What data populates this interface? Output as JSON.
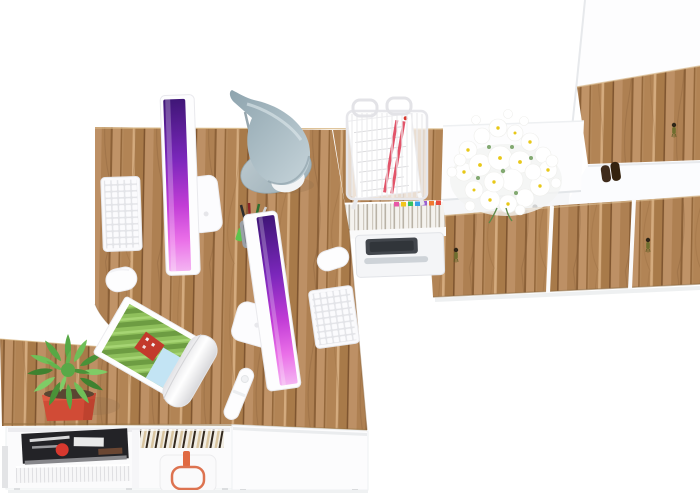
{
  "image": {
    "description": "Top-down 3D render of a two-person home office workstation with oak and white furniture",
    "background": "#ffffff"
  },
  "palette": {
    "wood_base": "#b5895b",
    "wood_dark": "#8a6138",
    "wood_light": "#d4ab7e",
    "white_furniture": "#fcfcfd",
    "shadow": "#eceef0",
    "screen_purple_dark": "#3f1677",
    "screen_purple_mid": "#c23dd6",
    "screen_purple_light": "#f4b4f2",
    "lamp_gray_blue": "#a3b8c0",
    "plant_green": "#57a845",
    "pot_red": "#d14b36",
    "daisy_yellow": "#e8c818",
    "paper_stripe_red": "#e2556a",
    "bag_handle_copper": "#dd7350",
    "printer_dark": "#42464c",
    "key_tassel_olive": "#6e6e2e"
  },
  "objects": {
    "desk": {
      "label": "oak desktop with cable cutout"
    },
    "side_table": {
      "label": "oak side return"
    },
    "imac1": {
      "label": "iMac workstation 1"
    },
    "imac2": {
      "label": "iMac workstation 2"
    },
    "keyboard1": {
      "label": "white keyboard 1"
    },
    "keyboard2": {
      "label": "white keyboard 2"
    },
    "mouse1": {
      "label": "white mouse 1"
    },
    "mouse2": {
      "label": "white mouse 2"
    },
    "lamp": {
      "label": "gray desk lamp"
    },
    "pen_cup": {
      "label": "pen cup with pens"
    },
    "paper_tray": {
      "label": "wire paper tray with documents"
    },
    "magazine": {
      "label": "rolled magazine with landscape cover"
    },
    "remote": {
      "label": "white remote control"
    },
    "plant": {
      "label": "succulent in red pot"
    },
    "daisies": {
      "label": "daisy bouquet on countertop"
    },
    "countertop": {
      "label": "white sideboard countertop"
    },
    "binder_shelf": {
      "label": "shelf with binders and colored tabs"
    },
    "printer": {
      "label": "printer in sideboard"
    },
    "doors": {
      "label": "oak sideboard doors with keys"
    },
    "tall_cabinet": {
      "label": "tall white and oak cabinet"
    },
    "cabinet_item": {
      "label": "dark item on cabinet shelf"
    },
    "drawer_unit": {
      "label": "white under-desk drawer unit"
    },
    "low_sideboard": {
      "label": "low white sideboard with magazines"
    },
    "magazine_stack": {
      "label": "magazine stack"
    },
    "paper_stack": {
      "label": "paper stack"
    },
    "books_row": {
      "label": "row of books"
    },
    "bag": {
      "label": "white bag with copper handle"
    }
  }
}
